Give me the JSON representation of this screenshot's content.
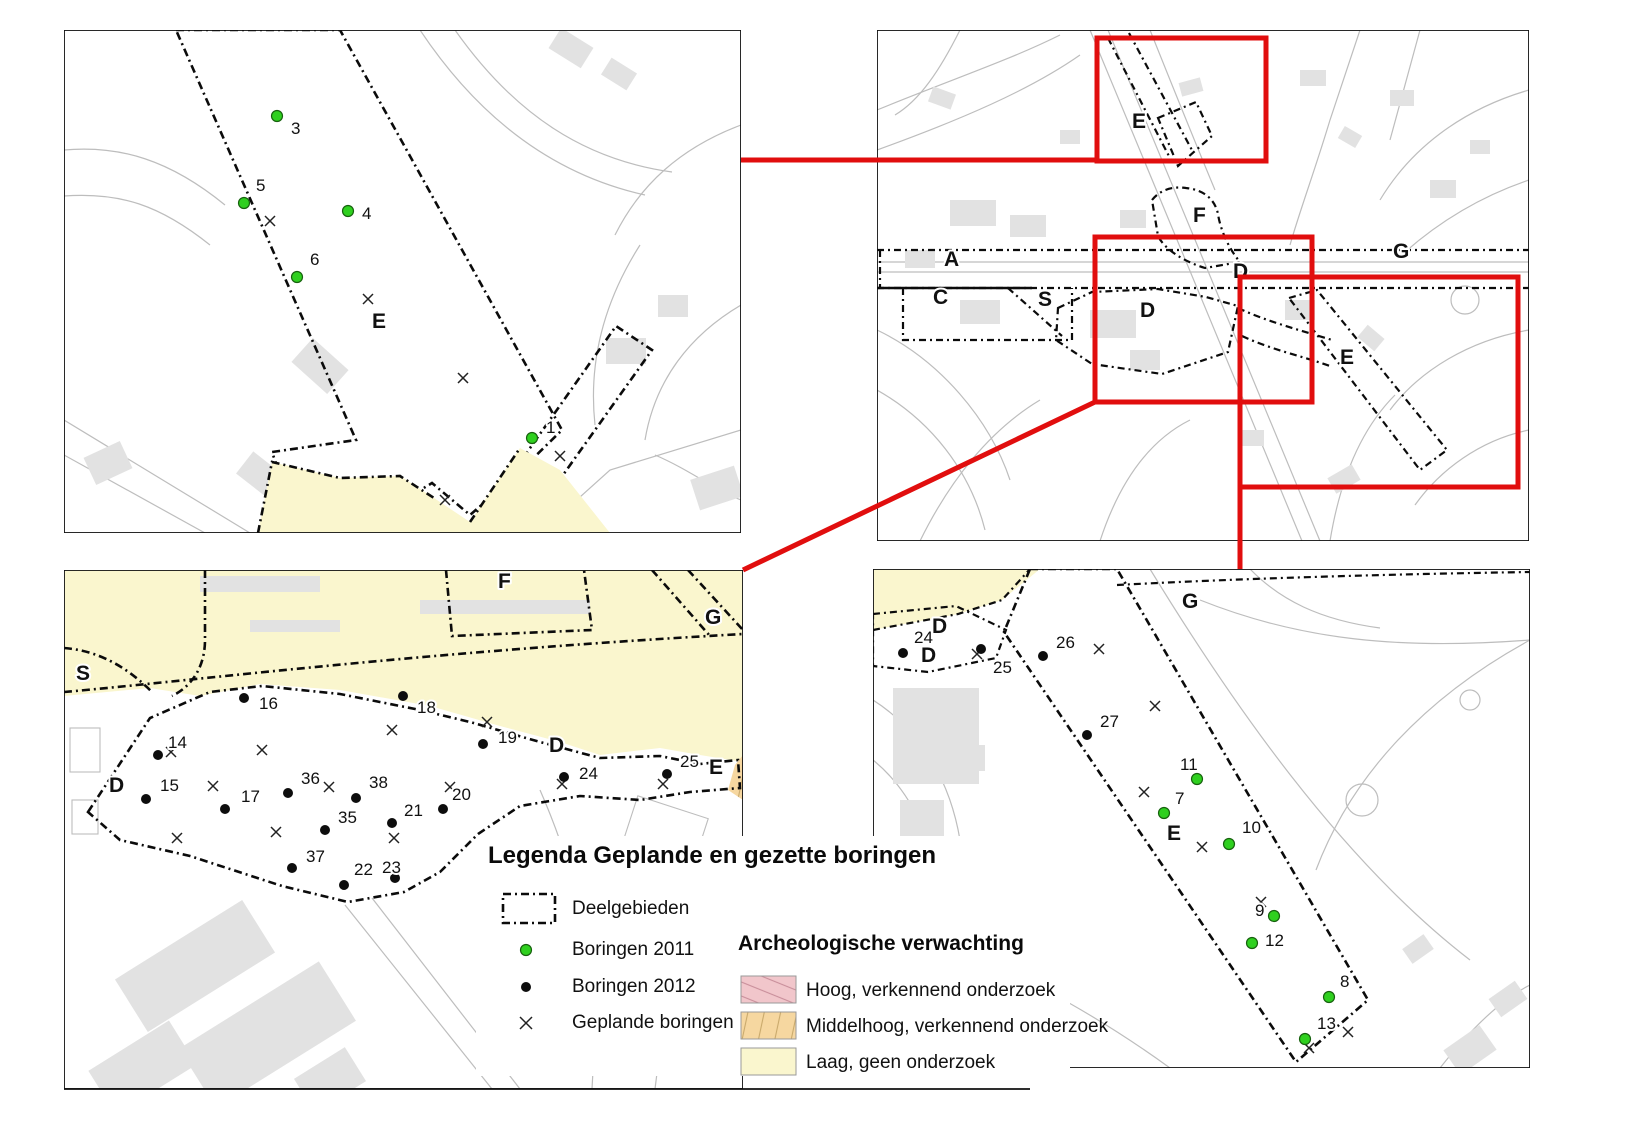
{
  "colors": {
    "middelhoog_orange": "#F6D7A0",
    "orange_hatch_line": "#C9A96B",
    "hoog_pink": "#F1C6CB",
    "pink_hatch_line": "#C98F9B",
    "laag_yellow": "#FAF6CE",
    "boring_2011_green": "#2FD01F",
    "boring_2012_black": "#0D0D0D",
    "highlight_red": "#E10E0E",
    "map_line_gray": "#BDBDBD",
    "building_gray": "#E2E2E2",
    "boundary_black": "#0B0B0B"
  },
  "legend": {
    "title": "Legenda Geplande en gezette boringen",
    "symbols": [
      {
        "key": "deelgebieden",
        "label": "Deelgebieden"
      },
      {
        "key": "boringen-2011",
        "label": "Boringen 2011"
      },
      {
        "key": "boringen-2012",
        "label": "Boringen 2012"
      },
      {
        "key": "geplande-boringen",
        "label": "Geplande boringen"
      }
    ],
    "expectation_heading": "Archeologische verwachting",
    "expectation_items": [
      {
        "key": "hoog",
        "label": "Hoog, verkennend onderzoek"
      },
      {
        "key": "middelhoog",
        "label": "Middelhoog, verkennend onderzoek"
      },
      {
        "key": "laag",
        "label": "Laag, geen onderzoek"
      }
    ]
  },
  "panels": {
    "top_left": {
      "description": "detail map area E north",
      "area_labels": [
        {
          "text": "E",
          "x": 372,
          "y": 312
        }
      ],
      "borings_2011": [
        {
          "n": "3",
          "x": 277,
          "y": 116,
          "lx": 291,
          "ly": 121
        },
        {
          "n": "5",
          "x": 244,
          "y": 203,
          "lx": 256,
          "ly": 178
        },
        {
          "n": "4",
          "x": 348,
          "y": 211,
          "lx": 362,
          "ly": 206
        },
        {
          "n": "6",
          "x": 297,
          "y": 277,
          "lx": 310,
          "ly": 252
        },
        {
          "n": "1",
          "x": 532,
          "y": 438,
          "lx": 546,
          "ly": 420
        }
      ],
      "borings_2012": [],
      "planned": [
        {
          "x": 270,
          "y": 221
        },
        {
          "x": 368,
          "y": 299
        },
        {
          "x": 463,
          "y": 378
        },
        {
          "x": 560,
          "y": 456
        },
        {
          "x": 445,
          "y": 500
        }
      ]
    },
    "top_right": {
      "description": "overview map with highlight rectangles",
      "area_labels": [
        {
          "text": "E",
          "x": 1132,
          "y": 112
        },
        {
          "text": "F",
          "x": 1193,
          "y": 206
        },
        {
          "text": "A",
          "x": 944,
          "y": 250
        },
        {
          "text": "C",
          "x": 933,
          "y": 288
        },
        {
          "text": "S",
          "x": 1038,
          "y": 290
        },
        {
          "text": "D",
          "x": 1233,
          "y": 262
        },
        {
          "text": "D",
          "x": 1140,
          "y": 301
        },
        {
          "text": "G",
          "x": 1393,
          "y": 242
        },
        {
          "text": "E",
          "x": 1340,
          "y": 348
        }
      ],
      "borings_2011": [],
      "borings_2012": [],
      "planned": []
    },
    "bottom_left": {
      "description": "detail map area D west with high expectation zone",
      "area_labels": [
        {
          "text": "S",
          "x": 76,
          "y": 664
        },
        {
          "text": "F",
          "x": 498,
          "y": 572
        },
        {
          "text": "G",
          "x": 705,
          "y": 608
        },
        {
          "text": "D",
          "x": 109,
          "y": 776
        },
        {
          "text": "D",
          "x": 549,
          "y": 736
        },
        {
          "text": "E",
          "x": 709,
          "y": 758
        }
      ],
      "borings_2011": [],
      "borings_2012": [
        {
          "n": "14",
          "x": 158,
          "y": 755,
          "lx": 168,
          "ly": 735
        },
        {
          "n": "15",
          "x": 146,
          "y": 799,
          "lx": 160,
          "ly": 778
        },
        {
          "n": "16",
          "x": 244,
          "y": 698,
          "lx": 259,
          "ly": 696
        },
        {
          "n": "17",
          "x": 225,
          "y": 809,
          "lx": 241,
          "ly": 789
        },
        {
          "n": "18",
          "x": 403,
          "y": 696,
          "lx": 417,
          "ly": 700
        },
        {
          "n": "19",
          "x": 483,
          "y": 744,
          "lx": 498,
          "ly": 730
        },
        {
          "n": "20",
          "x": 443,
          "y": 809,
          "lx": 452,
          "ly": 787
        },
        {
          "n": "21",
          "x": 392,
          "y": 823,
          "lx": 404,
          "ly": 803
        },
        {
          "n": "22",
          "x": 344,
          "y": 885,
          "lx": 354,
          "ly": 862
        },
        {
          "n": "23",
          "x": 395,
          "y": 878,
          "lx": 382,
          "ly": 860
        },
        {
          "n": "24",
          "x": 564,
          "y": 777,
          "lx": 579,
          "ly": 766
        },
        {
          "n": "25",
          "x": 667,
          "y": 774,
          "lx": 680,
          "ly": 754
        },
        {
          "n": "35",
          "x": 325,
          "y": 830,
          "lx": 338,
          "ly": 810
        },
        {
          "n": "36",
          "x": 288,
          "y": 793,
          "lx": 301,
          "ly": 771
        },
        {
          "n": "37",
          "x": 292,
          "y": 868,
          "lx": 306,
          "ly": 849
        },
        {
          "n": "38",
          "x": 356,
          "y": 798,
          "lx": 369,
          "ly": 775
        }
      ],
      "planned": [
        {
          "x": 171,
          "y": 752
        },
        {
          "x": 262,
          "y": 750
        },
        {
          "x": 392,
          "y": 730
        },
        {
          "x": 213,
          "y": 786
        },
        {
          "x": 329,
          "y": 787
        },
        {
          "x": 276,
          "y": 832
        },
        {
          "x": 177,
          "y": 838
        },
        {
          "x": 394,
          "y": 838
        },
        {
          "x": 487,
          "y": 722
        },
        {
          "x": 450,
          "y": 787
        },
        {
          "x": 562,
          "y": 784
        },
        {
          "x": 663,
          "y": 784
        }
      ]
    },
    "bottom_right": {
      "description": "detail map area E south strip",
      "area_labels": [
        {
          "text": "G",
          "x": 1182,
          "y": 592
        },
        {
          "text": "D",
          "x": 932,
          "y": 617
        },
        {
          "text": "D",
          "x": 921,
          "y": 646
        },
        {
          "text": "E",
          "x": 1167,
          "y": 824
        }
      ],
      "borings_2012": [
        {
          "n": "24",
          "x": 903,
          "y": 653,
          "lx": 914,
          "ly": 630
        },
        {
          "n": "25",
          "x": 981,
          "y": 649,
          "lx": 993,
          "ly": 660
        },
        {
          "n": "26",
          "x": 1043,
          "y": 656,
          "lx": 1056,
          "ly": 635
        },
        {
          "n": "27",
          "x": 1087,
          "y": 735,
          "lx": 1100,
          "ly": 714
        }
      ],
      "borings_2011": [
        {
          "n": "11",
          "x": 1197,
          "y": 779,
          "lx": 1180,
          "ly": 757
        },
        {
          "n": "7",
          "x": 1164,
          "y": 813,
          "lx": 1175,
          "ly": 791
        },
        {
          "n": "10",
          "x": 1229,
          "y": 844,
          "lx": 1242,
          "ly": 820
        },
        {
          "n": "9",
          "x": 1274,
          "y": 916,
          "lx": 1255,
          "ly": 903
        },
        {
          "n": "12",
          "x": 1252,
          "y": 943,
          "lx": 1265,
          "ly": 933
        },
        {
          "n": "8",
          "x": 1329,
          "y": 997,
          "lx": 1340,
          "ly": 974
        },
        {
          "n": "13",
          "x": 1305,
          "y": 1039,
          "lx": 1317,
          "ly": 1016
        }
      ],
      "planned": [
        {
          "x": 977,
          "y": 654
        },
        {
          "x": 1099,
          "y": 649
        },
        {
          "x": 1155,
          "y": 706
        },
        {
          "x": 1144,
          "y": 792
        },
        {
          "x": 1202,
          "y": 847
        },
        {
          "x": 1261,
          "y": 902
        },
        {
          "x": 1309,
          "y": 1048
        },
        {
          "x": 1348,
          "y": 1032
        }
      ]
    }
  }
}
